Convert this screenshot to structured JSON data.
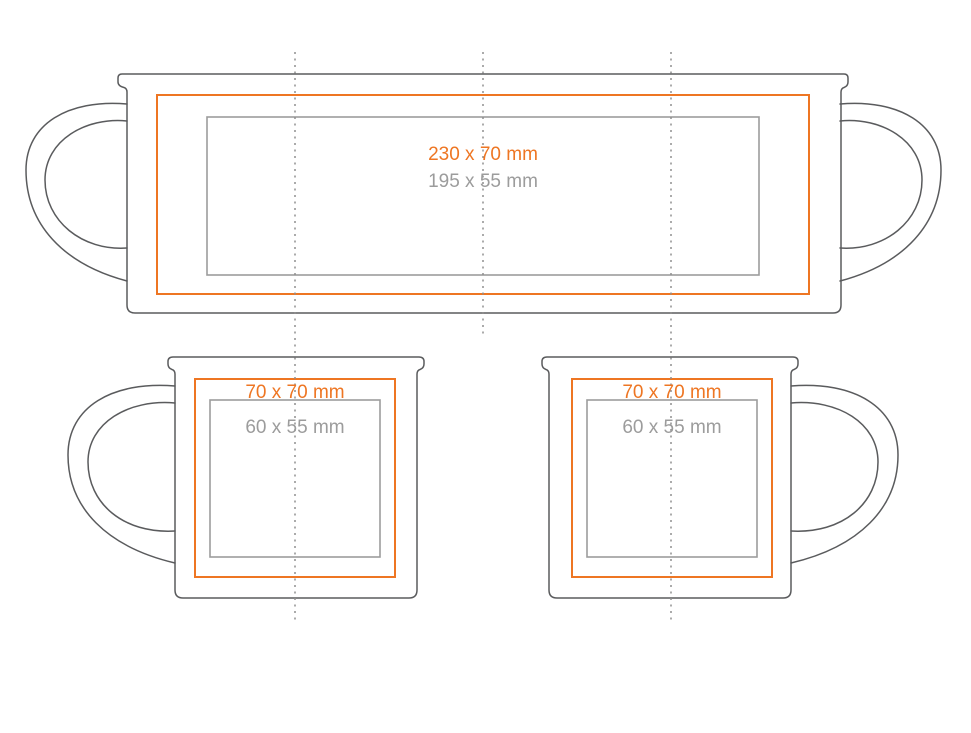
{
  "colors": {
    "max_area": "#ee7623",
    "safe_area": "#9c9c9c",
    "outline": "#5a5b5d",
    "fold_line": "#8f8f8f"
  },
  "wrap_view": {
    "max_area_label": "230 x 70 mm",
    "safe_area_label": "195 x 55 mm"
  },
  "left_mug_view": {
    "max_area_label": "70 x 70 mm",
    "safe_area_label": "60 x 55 mm"
  },
  "right_mug_view": {
    "max_area_label": "70 x 70 mm",
    "safe_area_label": "60 x 55 mm"
  }
}
